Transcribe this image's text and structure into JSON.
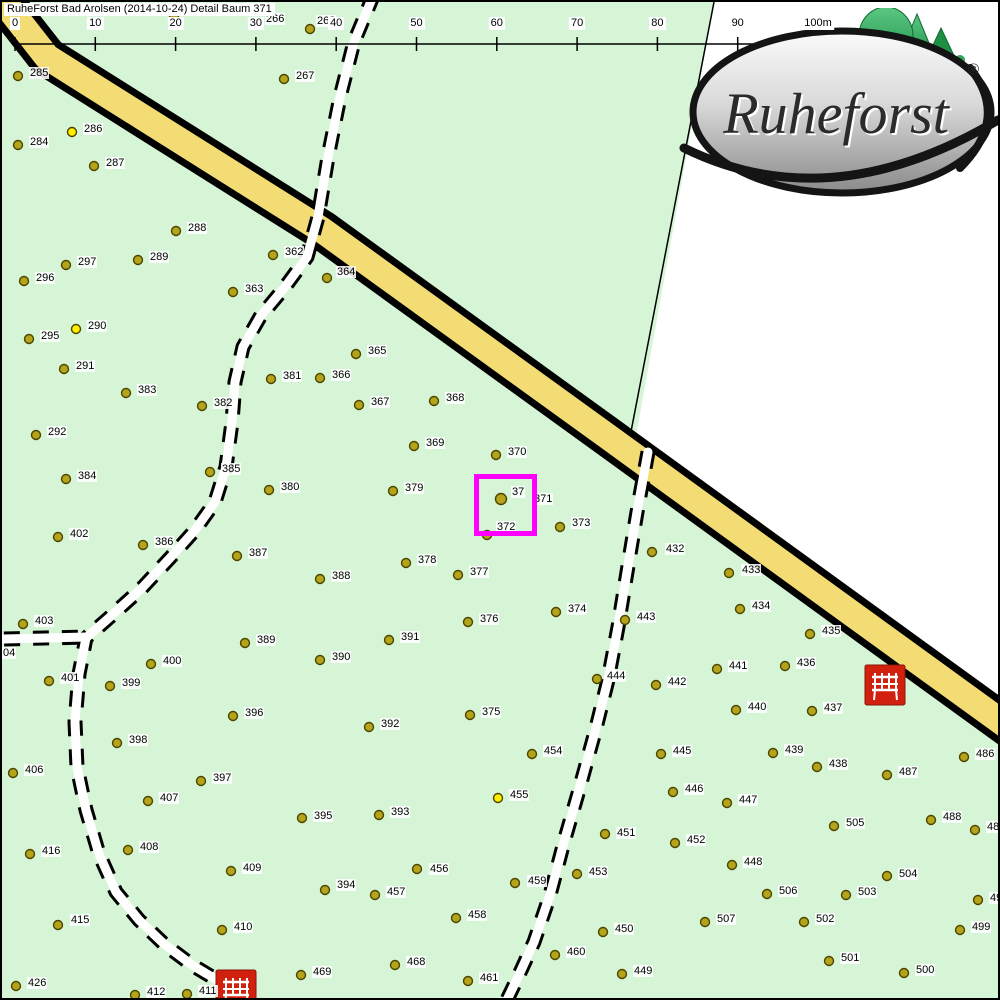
{
  "title": "RuheForst Bad Arolsen (2014-10-24) Detail  Baum 371",
  "logo": {
    "brand": "Ruheforst",
    "registered": "®"
  },
  "colors": {
    "map_green": "#d6f5d6",
    "road_yellow": "#f2dc73",
    "road_edge": "#000000",
    "tree_fill": "#b3a41c",
    "tree_stroke": "#4d4400",
    "marked_tree_fill": "#ffee00",
    "highlight": "#ff00ff",
    "bench_red": "#d2200f",
    "white_area": "#ffffff"
  },
  "scale_bar": {
    "y": 42,
    "x0": 13,
    "dx": 80.3,
    "tick_len": 13,
    "labels": [
      "0",
      "10",
      "20",
      "30",
      "40",
      "50",
      "60",
      "70",
      "80",
      "90",
      "100m"
    ]
  },
  "highlight_box": {
    "x": 472,
    "y": 472,
    "w": 53,
    "h": 52,
    "inner_label": "37",
    "outer_label": "371",
    "outer_lx": 531,
    "outer_ly": 491,
    "inner_lx": 509,
    "inner_ly": 484
  },
  "benches": [
    {
      "x": 863,
      "y": 663
    },
    {
      "x": 214,
      "y": 968
    }
  ],
  "map_features": {
    "white_wedge": [
      [
        712,
        0
      ],
      [
        1005,
        -2
      ],
      [
        1005,
        720
      ],
      [
        632,
        445
      ]
    ],
    "boundary_line": [
      [
        712,
        0
      ],
      [
        627,
        440
      ]
    ],
    "road": [
      [
        -45,
        -60
      ],
      [
        45,
        55
      ],
      [
        320,
        228
      ],
      [
        605,
        434
      ],
      [
        878,
        632
      ],
      [
        1085,
        782
      ]
    ],
    "paths": [
      [
        [
          372,
          -8
        ],
        [
          352,
          40
        ],
        [
          338,
          95
        ],
        [
          326,
          155
        ],
        [
          316,
          215
        ],
        [
          305,
          255
        ],
        [
          283,
          285
        ],
        [
          258,
          315
        ],
        [
          241,
          345
        ],
        [
          233,
          380
        ],
        [
          230,
          420
        ],
        [
          224,
          465
        ],
        [
          213,
          500
        ],
        [
          193,
          528
        ],
        [
          168,
          556
        ],
        [
          140,
          586
        ],
        [
          108,
          615
        ],
        [
          84,
          636
        ],
        [
          77,
          672
        ],
        [
          73,
          720
        ],
        [
          75,
          765
        ],
        [
          84,
          808
        ],
        [
          97,
          852
        ],
        [
          114,
          890
        ],
        [
          137,
          918
        ],
        [
          162,
          942
        ],
        [
          190,
          963
        ],
        [
          215,
          978
        ],
        [
          232,
          987
        ]
      ],
      [
        [
          2,
          637
        ],
        [
          84,
          635
        ]
      ],
      [
        [
          646,
          450
        ],
        [
          635,
          510
        ],
        [
          625,
          570
        ],
        [
          616,
          625
        ],
        [
          606,
          678
        ],
        [
          593,
          730
        ],
        [
          577,
          788
        ],
        [
          562,
          840
        ],
        [
          548,
          893
        ],
        [
          532,
          940
        ],
        [
          516,
          975
        ],
        [
          503,
          1002
        ]
      ]
    ]
  },
  "trees": [
    {
      "n": "",
      "x": 172,
      "y": 14
    },
    {
      "n": "266",
      "x": 263,
      "y": 11,
      "dot": false,
      "lx": 263,
      "ly": 11
    },
    {
      "n": "268",
      "x": 308,
      "y": 27,
      "lx": 314,
      "ly": 13
    },
    {
      "n": "267",
      "x": 282,
      "y": 77
    },
    {
      "n": "285",
      "x": 16,
      "y": 74
    },
    {
      "n": "286",
      "x": 70,
      "y": 130,
      "c": "y"
    },
    {
      "n": "284",
      "x": 16,
      "y": 143
    },
    {
      "n": "287",
      "x": 92,
      "y": 164
    },
    {
      "n": "288",
      "x": 174,
      "y": 229
    },
    {
      "n": "297",
      "x": 64,
      "y": 263
    },
    {
      "n": "289",
      "x": 136,
      "y": 258
    },
    {
      "n": "296",
      "x": 22,
      "y": 279
    },
    {
      "n": "362",
      "x": 271,
      "y": 253
    },
    {
      "n": "363",
      "x": 231,
      "y": 290
    },
    {
      "n": "364",
      "x": 325,
      "y": 276,
      "lx": 334,
      "ly": 264
    },
    {
      "n": "295",
      "x": 27,
      "y": 337
    },
    {
      "n": "290",
      "x": 74,
      "y": 327,
      "c": "y"
    },
    {
      "n": "291",
      "x": 62,
      "y": 367
    },
    {
      "n": "383",
      "x": 124,
      "y": 391
    },
    {
      "n": "365",
      "x": 354,
      "y": 352
    },
    {
      "n": "381",
      "x": 269,
      "y": 377
    },
    {
      "n": "366",
      "x": 318,
      "y": 376
    },
    {
      "n": "382",
      "x": 200,
      "y": 404
    },
    {
      "n": "367",
      "x": 357,
      "y": 403
    },
    {
      "n": "368",
      "x": 432,
      "y": 399
    },
    {
      "n": "292",
      "x": 34,
      "y": 433
    },
    {
      "n": "369",
      "x": 412,
      "y": 444
    },
    {
      "n": "370",
      "x": 494,
      "y": 453
    },
    {
      "n": "385",
      "x": 208,
      "y": 470
    },
    {
      "n": "384",
      "x": 64,
      "y": 477
    },
    {
      "n": "380",
      "x": 267,
      "y": 488
    },
    {
      "n": "379",
      "x": 391,
      "y": 489
    },
    {
      "n": "371",
      "x": 499,
      "y": 497,
      "sel": true,
      "dot": true,
      "lx": -100,
      "ly": -100
    },
    {
      "n": "372",
      "x": 485,
      "y": 533,
      "lx": 494,
      "ly": 519
    },
    {
      "n": "373",
      "x": 558,
      "y": 525,
      "lx": 569,
      "ly": 515
    },
    {
      "n": "402",
      "x": 56,
      "y": 535
    },
    {
      "n": "386",
      "x": 141,
      "y": 543
    },
    {
      "n": "387",
      "x": 235,
      "y": 554
    },
    {
      "n": "378",
      "x": 404,
      "y": 561
    },
    {
      "n": "377",
      "x": 456,
      "y": 573
    },
    {
      "n": "432",
      "x": 650,
      "y": 550,
      "lx": 663,
      "ly": 541
    },
    {
      "n": "433",
      "x": 727,
      "y": 571,
      "lx": 739,
      "ly": 562
    },
    {
      "n": "388",
      "x": 318,
      "y": 577
    },
    {
      "n": "374",
      "x": 554,
      "y": 610
    },
    {
      "n": "434",
      "x": 738,
      "y": 607
    },
    {
      "n": "443",
      "x": 623,
      "y": 618
    },
    {
      "n": "376",
      "x": 466,
      "y": 620
    },
    {
      "n": "403",
      "x": 21,
      "y": 622
    },
    {
      "n": "04",
      "x": 0,
      "y": 652,
      "dot": false,
      "lx": 0,
      "ly": 645
    },
    {
      "n": "389",
      "x": 243,
      "y": 641
    },
    {
      "n": "391",
      "x": 387,
      "y": 638
    },
    {
      "n": "435",
      "x": 808,
      "y": 632
    },
    {
      "n": "390",
      "x": 318,
      "y": 658
    },
    {
      "n": "400",
      "x": 149,
      "y": 662
    },
    {
      "n": "436",
      "x": 783,
      "y": 664
    },
    {
      "n": "441",
      "x": 715,
      "y": 667
    },
    {
      "n": "401",
      "x": 47,
      "y": 679
    },
    {
      "n": "399",
      "x": 108,
      "y": 684
    },
    {
      "n": "444",
      "x": 595,
      "y": 677,
      "lx": 604,
      "ly": 668
    },
    {
      "n": "442",
      "x": 654,
      "y": 683
    },
    {
      "n": "440",
      "x": 734,
      "y": 708
    },
    {
      "n": "437",
      "x": 810,
      "y": 709
    },
    {
      "n": "396",
      "x": 231,
      "y": 714
    },
    {
      "n": "375",
      "x": 468,
      "y": 713
    },
    {
      "n": "392",
      "x": 367,
      "y": 725
    },
    {
      "n": "445",
      "x": 659,
      "y": 752
    },
    {
      "n": "398",
      "x": 115,
      "y": 741
    },
    {
      "n": "454",
      "x": 530,
      "y": 752
    },
    {
      "n": "439",
      "x": 771,
      "y": 751
    },
    {
      "n": "438",
      "x": 815,
      "y": 765
    },
    {
      "n": "486",
      "x": 962,
      "y": 755
    },
    {
      "n": "406",
      "x": 11,
      "y": 771
    },
    {
      "n": "487",
      "x": 885,
      "y": 773
    },
    {
      "n": "397",
      "x": 199,
      "y": 779
    },
    {
      "n": "446",
      "x": 671,
      "y": 790
    },
    {
      "n": "455",
      "x": 496,
      "y": 796,
      "c": "y"
    },
    {
      "n": "407",
      "x": 146,
      "y": 799
    },
    {
      "n": "393",
      "x": 377,
      "y": 813
    },
    {
      "n": "395",
      "x": 300,
      "y": 816,
      "lx": 311,
      "ly": 808
    },
    {
      "n": "447",
      "x": 725,
      "y": 801
    },
    {
      "n": "505",
      "x": 832,
      "y": 824
    },
    {
      "n": "488",
      "x": 929,
      "y": 818
    },
    {
      "n": "451",
      "x": 603,
      "y": 832,
      "lx": 614,
      "ly": 825
    },
    {
      "n": "452",
      "x": 673,
      "y": 841
    },
    {
      "n": "416",
      "x": 28,
      "y": 852
    },
    {
      "n": "408",
      "x": 126,
      "y": 848
    },
    {
      "n": "489",
      "x": 973,
      "y": 828,
      "lx": 984,
      "ly": 819
    },
    {
      "n": "448",
      "x": 730,
      "y": 863
    },
    {
      "n": "504",
      "x": 885,
      "y": 874,
      "lx": 896,
      "ly": 866
    },
    {
      "n": "409",
      "x": 229,
      "y": 869
    },
    {
      "n": "456",
      "x": 415,
      "y": 867,
      "lx": 427,
      "ly": 861
    },
    {
      "n": "453",
      "x": 575,
      "y": 872,
      "lx": 586,
      "ly": 864
    },
    {
      "n": "459",
      "x": 513,
      "y": 881,
      "lx": 525,
      "ly": 873
    },
    {
      "n": "506",
      "x": 765,
      "y": 892
    },
    {
      "n": "503",
      "x": 844,
      "y": 893
    },
    {
      "n": "394",
      "x": 323,
      "y": 888,
      "lx": 334,
      "ly": 877
    },
    {
      "n": "457",
      "x": 373,
      "y": 893,
      "lx": 384,
      "ly": 884
    },
    {
      "n": "415",
      "x": 56,
      "y": 923,
      "lx": 68,
      "ly": 912
    },
    {
      "n": "458",
      "x": 454,
      "y": 916
    },
    {
      "n": "507",
      "x": 703,
      "y": 920
    },
    {
      "n": "502",
      "x": 802,
      "y": 920
    },
    {
      "n": "450",
      "x": 601,
      "y": 930
    },
    {
      "n": "410",
      "x": 220,
      "y": 928
    },
    {
      "n": "499",
      "x": 958,
      "y": 928
    },
    {
      "n": "498",
      "x": 976,
      "y": 898,
      "lx": 987,
      "ly": 890
    },
    {
      "n": "460",
      "x": 553,
      "y": 953
    },
    {
      "n": "449",
      "x": 620,
      "y": 972
    },
    {
      "n": "501",
      "x": 827,
      "y": 959
    },
    {
      "n": "468",
      "x": 393,
      "y": 963
    },
    {
      "n": "469",
      "x": 299,
      "y": 973
    },
    {
      "n": "426",
      "x": 14,
      "y": 984
    },
    {
      "n": "500",
      "x": 902,
      "y": 971
    },
    {
      "n": "461",
      "x": 466,
      "y": 979
    },
    {
      "n": "411",
      "x": 185,
      "y": 992
    },
    {
      "n": "412",
      "x": 133,
      "y": 993
    }
  ]
}
